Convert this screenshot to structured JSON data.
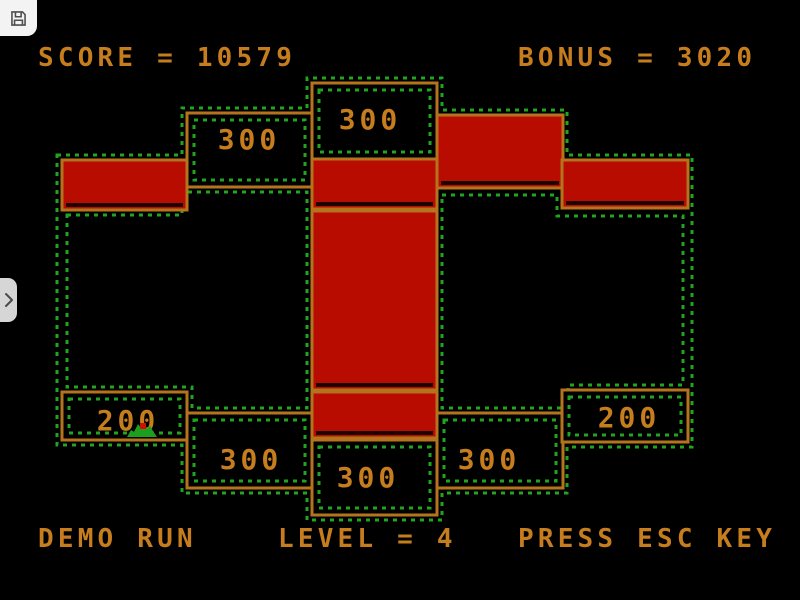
{
  "toolbar": {
    "save_button_icon": "floppy-disk-icon",
    "sidebar_toggle_icon": "chevron-right-icon"
  },
  "hud": {
    "score_text": "SCORE = 10579",
    "score_value": 10579,
    "bonus_text": "BONUS = 3020",
    "bonus_value": 3020,
    "demo_text": "DEMO RUN",
    "level_text": "LEVEL = 4",
    "level_value": 4,
    "esc_text": "PRESS ESC KEY"
  },
  "board": {
    "zones": [
      {
        "position": "top-left",
        "value": "300"
      },
      {
        "position": "top-center",
        "value": "300"
      },
      {
        "position": "bottom-far-left",
        "value": "200"
      },
      {
        "position": "bottom-left",
        "value": "300"
      },
      {
        "position": "bottom-center",
        "value": "300"
      },
      {
        "position": "bottom-right",
        "value": "300"
      },
      {
        "position": "bottom-far-right",
        "value": "200"
      }
    ],
    "colors": {
      "background": "#000000",
      "wall": "#b5731d",
      "text": "#c67d1d",
      "block": "#b90c00",
      "track": "#21a521",
      "sprite": "#1e9e1e"
    }
  }
}
